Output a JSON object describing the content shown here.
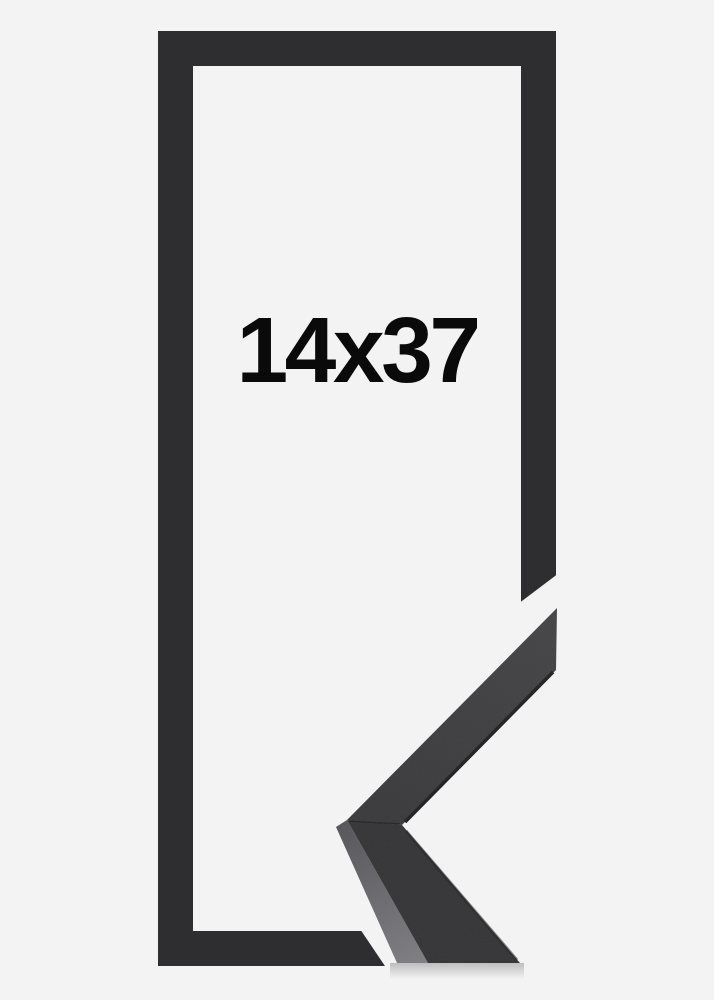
{
  "product": {
    "size_label": "14x37",
    "colors": {
      "background": "#f3f3f4",
      "frame": "#2e2e30",
      "label_text": "#0a0a0a",
      "sample_face_light": "#454547",
      "sample_face": "#3a3a3c",
      "sample_face_lower": "#353537",
      "sample_side_light": "#7e7e82",
      "sample_side_dark": "#55555a",
      "sample_edge": "#232325"
    }
  }
}
